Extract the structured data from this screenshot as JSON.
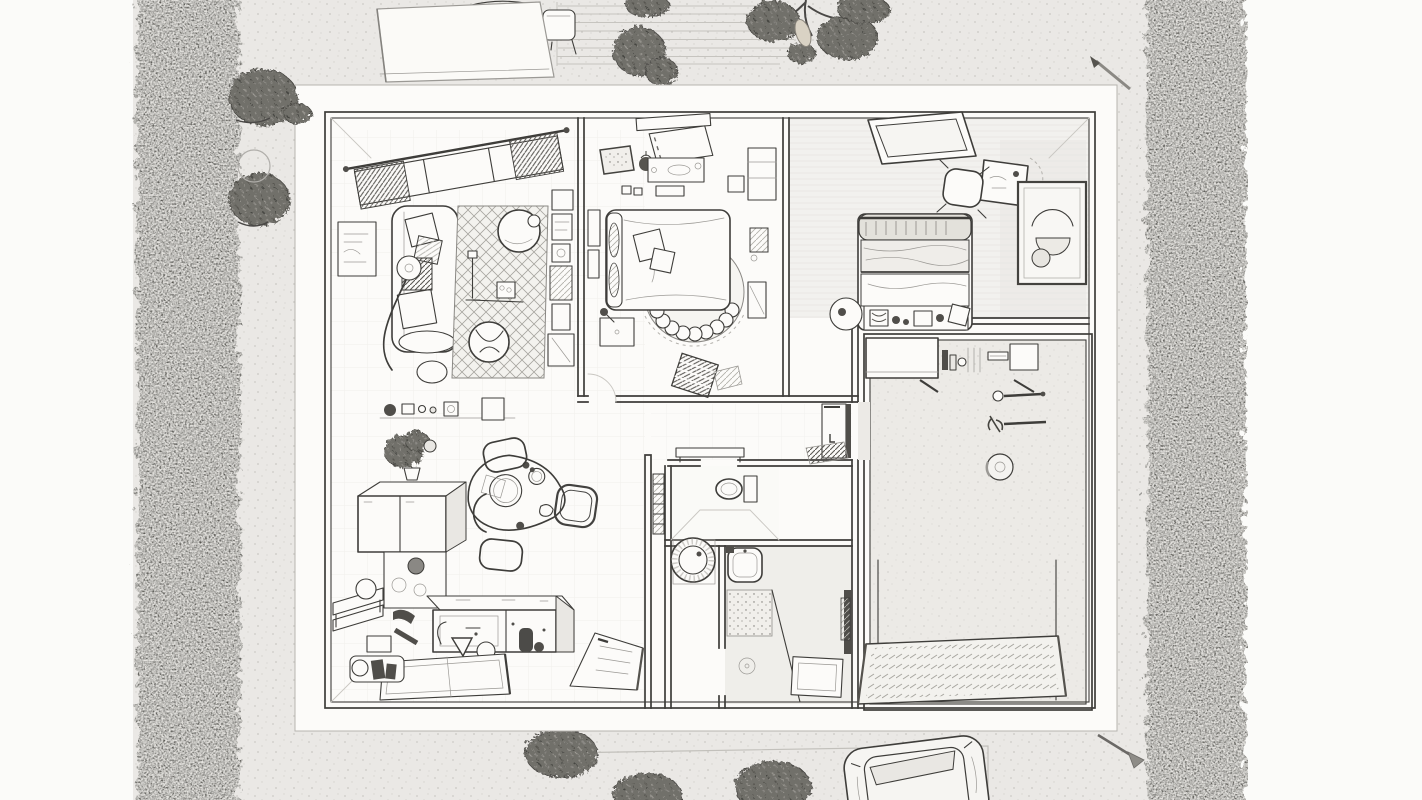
{
  "scene": {
    "type": "pencil-floor-plan-sketch",
    "canvas": {
      "width": 1422,
      "height": 800
    },
    "colors": {
      "paper": "#eae8e5",
      "margin": "#fbfbf9",
      "sheet": "#fcfbf9",
      "ink": "#3e3d3a",
      "faint_line": "#c9c7c2",
      "hedge": "#55534d",
      "hedge_speckle": "#c7c5c0",
      "foliage": "#716f6a",
      "ground_dot": "#b5b3ae",
      "wash": "#eceae6",
      "textile": "#d9d7d2",
      "dark_item": "#504e4a",
      "wood": "#e3e1db",
      "fruit": "#d9d2c4"
    },
    "exterior": {
      "left_hedge": "boxwood-hedge",
      "right_hedge": "boxwood-hedge",
      "elements": [
        "deck-awning",
        "deck-chair",
        "deck-table",
        "deck-steps",
        "shrubs",
        "garden-tree",
        "tree-fruit",
        "hand-tool-top",
        "hand-tool-bottom",
        "driveway-line",
        "parked-car",
        "overhanging-branches"
      ]
    },
    "house": {
      "rooms": [
        {
          "name": "living-room",
          "furniture": [
            "curtained-window",
            "wall-art",
            "sofa",
            "sofa-pillows",
            "arc-floor-lamp",
            "diamond-rug",
            "coffee-table",
            "reading-lamp",
            "side-table",
            "armchair",
            "pouf",
            "media-shelving"
          ]
        },
        {
          "name": "master-bedroom",
          "furniture": [
            "roller-blind-window",
            "dresser",
            "decor-tray",
            "potted-plant",
            "double-bed",
            "bed-pillows",
            "round-scallop-rug",
            "nightstand",
            "wall-frames",
            "storage-basket",
            "shelf-unit",
            "door-mat"
          ]
        },
        {
          "name": "second-bedroom",
          "furniture": [
            "skylight-window",
            "desk",
            "desk-chair",
            "abstract-wall-art",
            "single-bed",
            "storage-row",
            "round-side-table"
          ]
        },
        {
          "name": "hallway",
          "furniture": [
            "console-table",
            "open-dark-door",
            "hatched-door-mat"
          ]
        },
        {
          "name": "wc",
          "furniture": [
            "toilet",
            "towel-shelf"
          ]
        },
        {
          "name": "laundry-nook",
          "furniture": [
            "washing-machine"
          ]
        },
        {
          "name": "shower-room",
          "furniture": [
            "wash-basin",
            "speckled-shower-panel",
            "glass-screen",
            "floor-drain",
            "bath-mat",
            "towel-rail"
          ]
        },
        {
          "name": "main-bathroom",
          "furniture": [
            "vanity-unit",
            "toiletry-shelf",
            "towel-bar",
            "hanging-sprig",
            "paper-holder",
            "walk-in-shower-glass",
            "tiled-shower-tray"
          ]
        },
        {
          "name": "kitchen",
          "furniture": [
            "spice-shelf",
            "potted-plant",
            "refrigerator",
            "lower-cabinet",
            "side-bench",
            "bar-stool",
            "dark-tap",
            "kitchen-island",
            "sink-sketch",
            "island-knob",
            "grinder-set",
            "two-panel-rug",
            "serving-tray",
            "entry-mat",
            "dining-table",
            "dining-chairs",
            "plates"
          ]
        }
      ]
    }
  }
}
